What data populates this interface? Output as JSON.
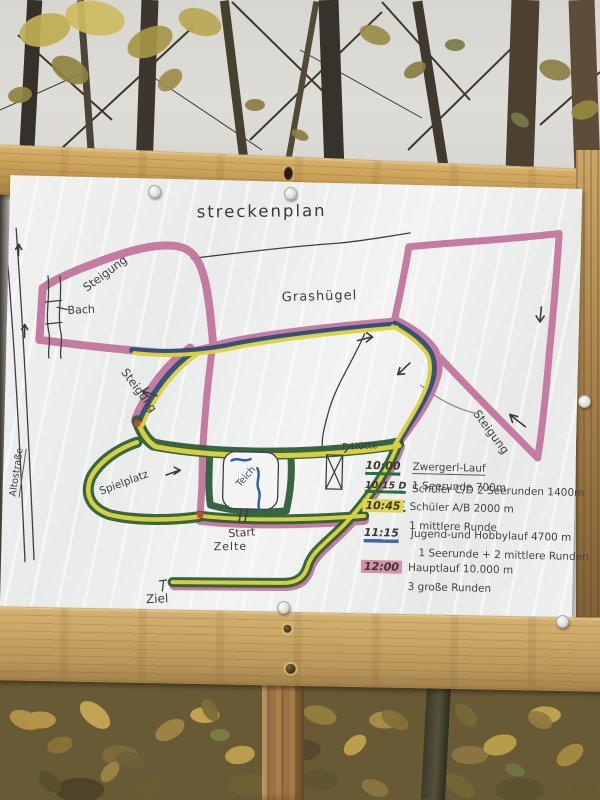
{
  "sign": {
    "title": "streckenplan",
    "map_labels": {
      "steigung_nw": "Steigung",
      "bach": "Bach",
      "grashuegel": "Grashügel",
      "steigung_w": "Steigung",
      "steigung_e": "Steigung",
      "altostrasse": "Altostraße",
      "spielplatz": "Spielplatz",
      "start": "Start",
      "zelte": "Zelte",
      "ziel": "Ziel",
      "f_huette": "F-Hütte",
      "teich": "Teich"
    },
    "legend": {
      "items": [
        {
          "time": "10:00",
          "marker": "green-underline",
          "title": "Zwergerl-Lauf",
          "detail": "1 Seerunde 700m"
        },
        {
          "time": "10:15 D",
          "time2": "10:30 C",
          "marker": "green-underline",
          "title": "Schüler C/D   2 Seerunden 1400m",
          "detail": ""
        },
        {
          "time": "10:45",
          "marker": "yellow-highlight",
          "title": "Schüler A/B   2000 m",
          "detail": "1 mittlere Runde"
        },
        {
          "time": "11:15",
          "marker": "blue-underline",
          "title": "Jugend-und Hobbylauf 4700 m",
          "detail": "1 Seerunde + 2 mittlere Runden"
        },
        {
          "time": "12:00",
          "marker": "pink-highlight",
          "title": "Hauptlauf 10.000 m",
          "detail": "3 große Runden"
        }
      ]
    },
    "colors": {
      "course_pink": "#c2739a",
      "course_yellow": "#ded33f",
      "course_green": "#2d5f38",
      "course_blue": "#2e4e79",
      "legend_blue": "#3c6ca8",
      "highlight_yellow": "#e0d44b",
      "highlight_pink": "#d490ab",
      "junction_red": "#c44a26",
      "water_blue": "#2a5fa5"
    }
  }
}
